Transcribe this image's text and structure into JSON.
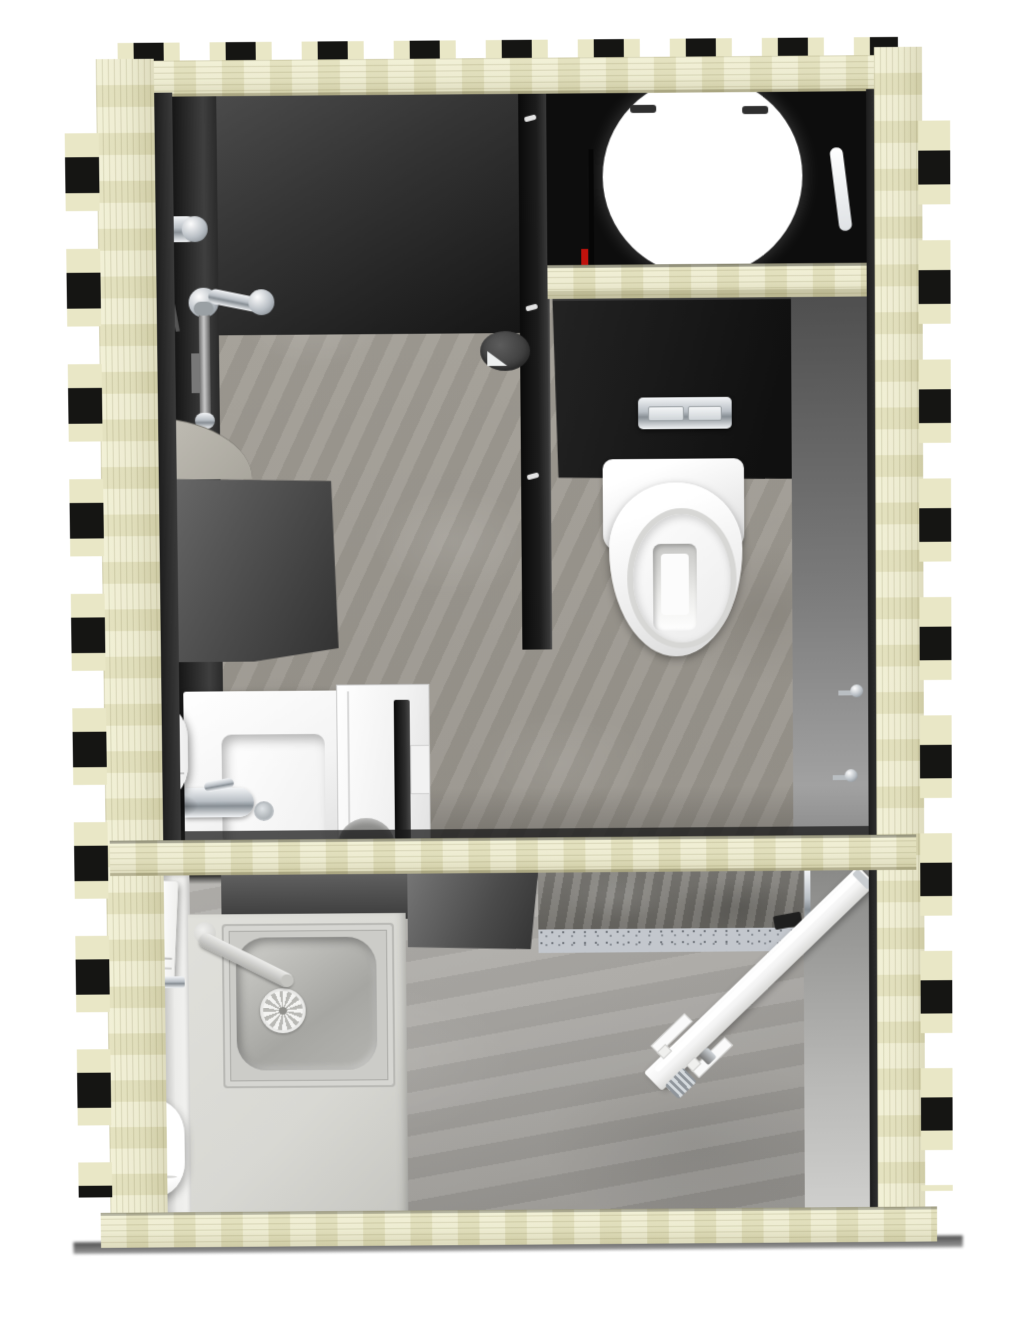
{
  "meta": {
    "title": "Top-down 3D cutaway floor plan of a timber-framed prefabricated sanitary unit",
    "view": "top-down cutaway",
    "style": "3D architectural rendering, no text labels"
  },
  "colors": {
    "bg": "#ffffff",
    "timber": "#e9e7c6",
    "timber-dark": "#d6d3ae",
    "notch": "#151513",
    "wall-black": "#0d0d0d",
    "wall-dark": "#3a3a3a",
    "wall-grey": "#9a9a9a",
    "floor-stone": "#a09c94",
    "floor-lower": "#a9a7a3",
    "concrete-rough": "#6e6c67",
    "speckle": "#c3c7cd",
    "counter": "#d8d8d3",
    "porcelain": "#fdfdfd",
    "chrome-light": "#f2f4f6",
    "chrome-mid": "#b9bfc5",
    "chrome-dark": "#878e94",
    "pipe-red": "#c0120c",
    "shadow": "#555555"
  },
  "structure": {
    "frame_label": "Interlocking notched timber frame (cross-cut)",
    "rooms": [
      {
        "name": "shower-area",
        "label": "Shower area"
      },
      {
        "name": "technical-compartment",
        "label": "Technical compartment with water tank"
      },
      {
        "name": "wc-area",
        "label": "WC area with wall-hung toilet"
      },
      {
        "name": "washbasin-area",
        "label": "Washbasin area with door"
      },
      {
        "name": "utility-room",
        "label": "Utility room with inset sink"
      },
      {
        "name": "entrance-area",
        "label": "Entrance area with open door"
      }
    ]
  },
  "fixtures": {
    "shower_set": "Chrome shower set with hand shower, mixer and slide bar",
    "floor_drain": "Round floor drain",
    "water_tank": "Cylindrical water tank (top view)",
    "tank_hatch": "White service hatch",
    "supply_pipe_red": "Red supply pipe",
    "tank_joist": "Timber joist under tank compartment",
    "cistern_wall": "Concealed cistern pre-wall",
    "flush_plate": "Chrome dual-flush plate",
    "toilet": "Wall-hung toilet (top view)",
    "coat_hook": "Chrome wall hook",
    "wall_light": "White wall panel",
    "shower_tray": "Quarter-round shower tray with drain",
    "partition_wall": "Partition wall element",
    "washbasin": "Square washbasin with chrome mixer tap",
    "soap_dispenser": "Soap dispenser",
    "interior_door": "Interior door (open) with seal and frame",
    "utility_sink": "Inset utility sink with spoke drain and tap",
    "paper_dispenser": "Paper towel dispenser",
    "roll_dispenser": "Round dispenser",
    "entrance_door": "Entrance door swung open with handle set",
    "door_hinge": "Door hinge strip",
    "middle_joist": "Timber cross joist",
    "ground_shadow": "Ground contact shadow"
  }
}
